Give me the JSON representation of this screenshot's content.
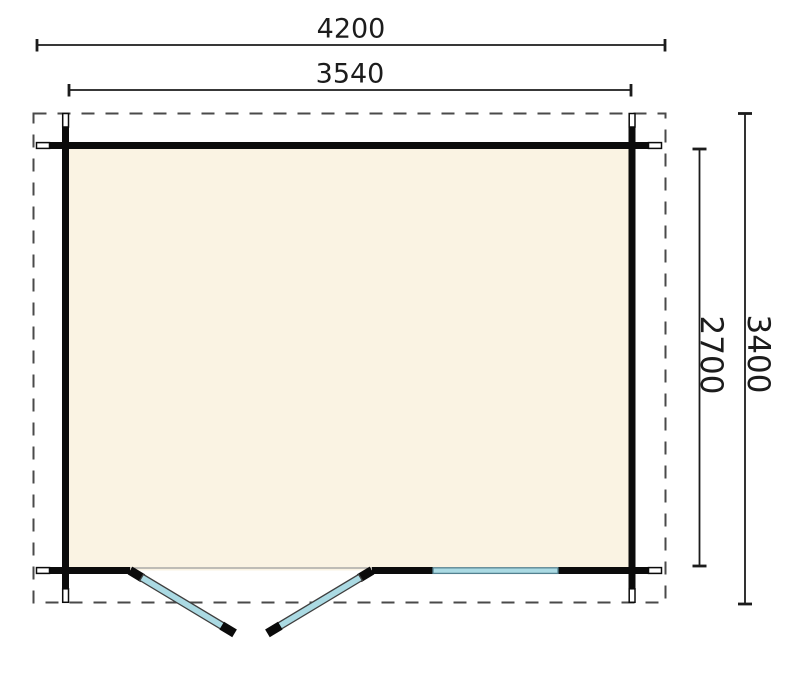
{
  "drawing": {
    "type": "log-cabin-floor-plan",
    "dimensions": {
      "overall_width_mm": "4200",
      "outer_wall_width_mm": "3540",
      "inner_depth_mm": "2700",
      "overall_depth_mm": "3400"
    },
    "colors": {
      "background": "#ffffff",
      "wall": "#0b0b0b",
      "floor_fill": "#faf3e3",
      "roof_dash": "#4a4a4a",
      "dim": "#1c1c1c",
      "glass_fill": "#abdae3",
      "glass_border": "#53808f",
      "leaf_outline": "#3f3f3f",
      "threshold": "#9a9a9a",
      "log_tip_fill": "#ffffff"
    }
  }
}
